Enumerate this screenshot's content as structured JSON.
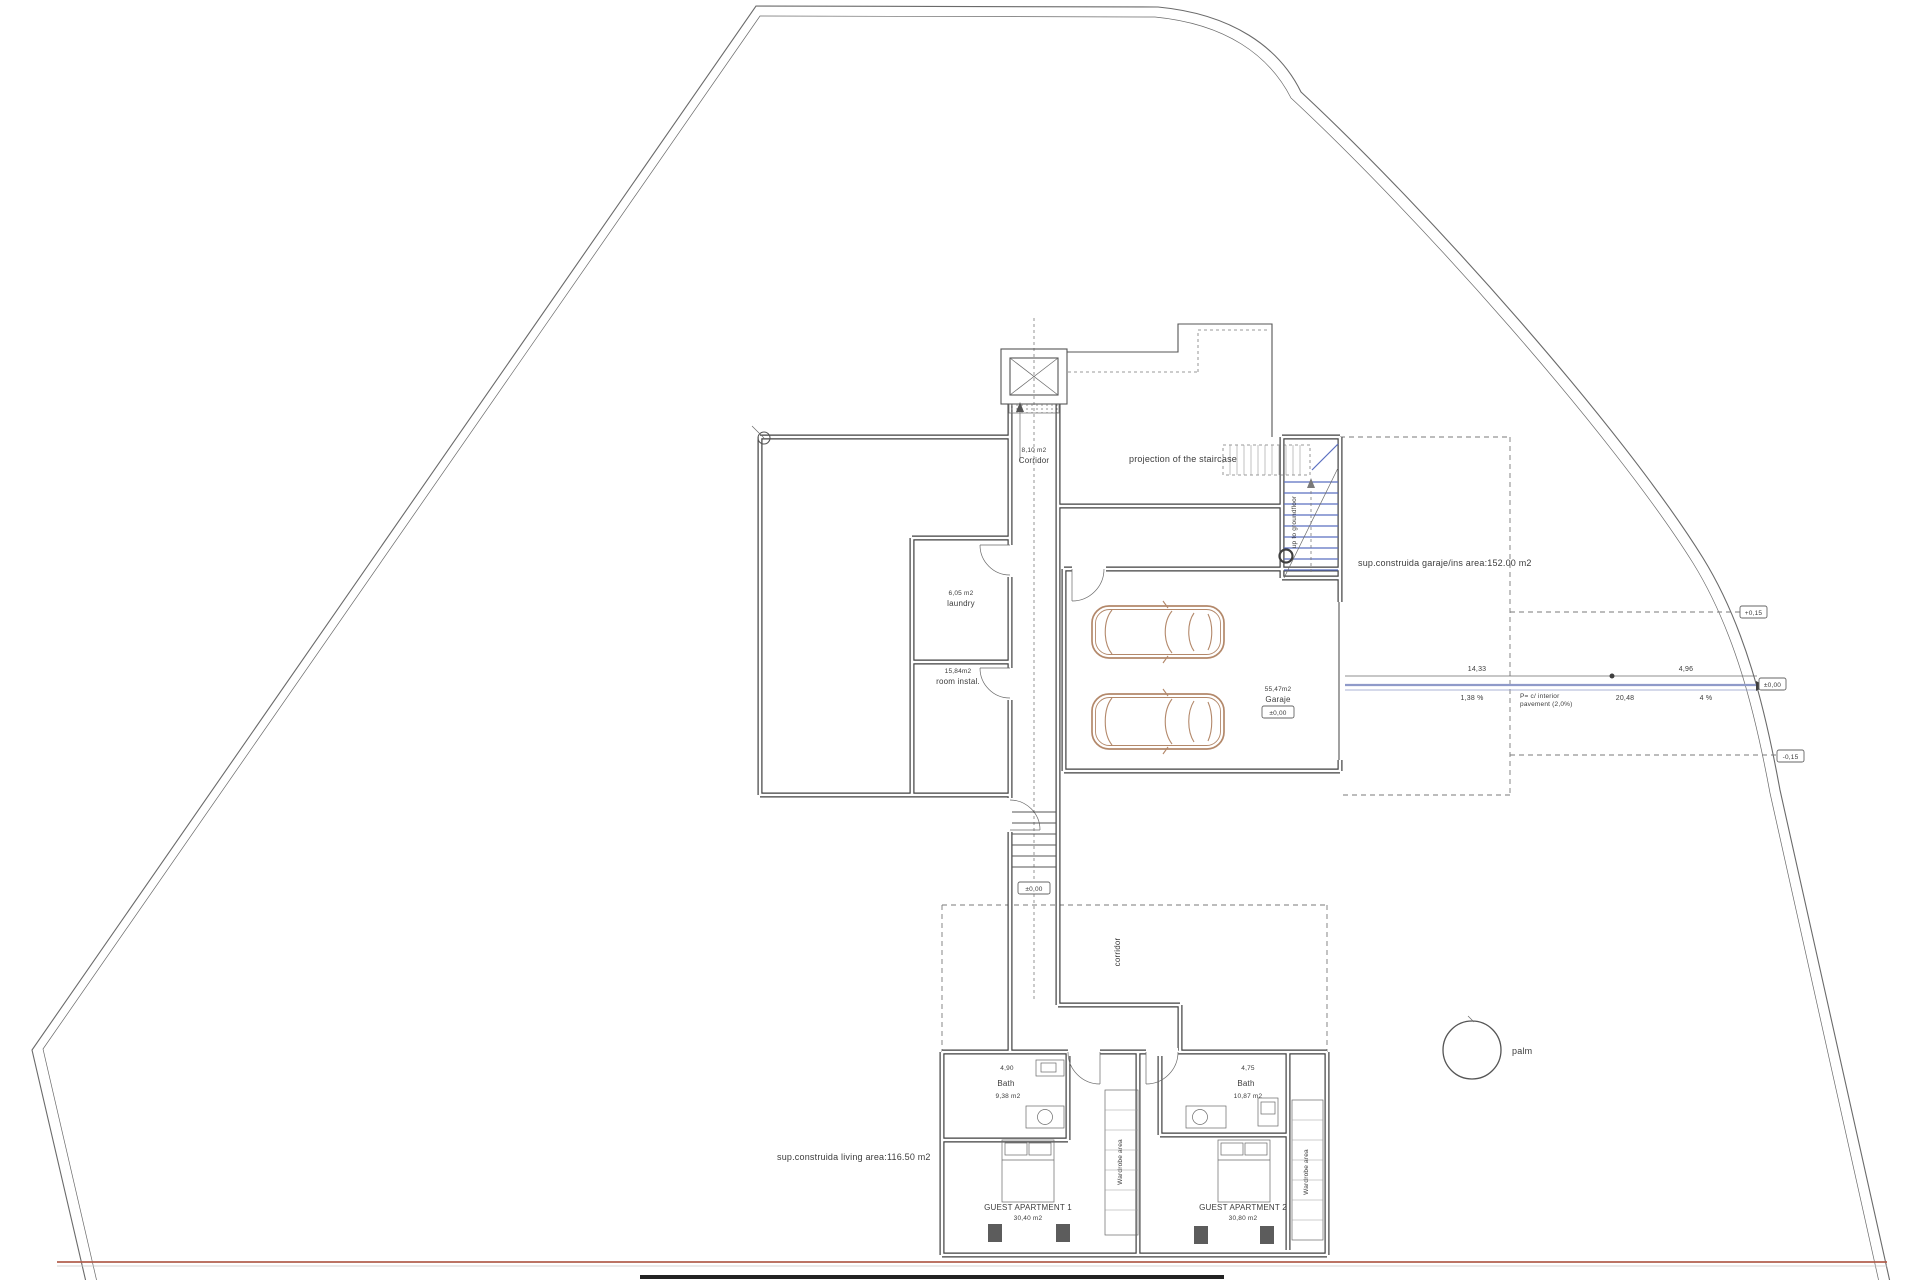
{
  "plan": {
    "colors": {
      "wall": "#3f3f3f",
      "line": "#555555",
      "stair": "#5b6fc0",
      "drive": "#8f9ac9",
      "car": "#b3886a",
      "street": "#b2604f",
      "text": "#3c3c3c"
    },
    "labels": {
      "projection_staircase": "projection of the staircase",
      "corridor_top_area": "8,10 m2",
      "corridor_top": "Corridor",
      "laundry_area": "6,05 m2",
      "laundry": "laundry",
      "instal_area": "15,84m2",
      "instal": "room instal.",
      "garage_area": "55,47m2",
      "garage": "Garaje",
      "garage_level": "±0,00",
      "garage_note": "sup.construida garaje/ins area:152.00 m2",
      "living_note": "sup.construida living area:116.50 m2",
      "up_stairs": "up to groundfloor",
      "stairs_level": "±0,00",
      "corridor_lower": "corridor",
      "bath1": "Bath",
      "bath1_area": "9,38 m2",
      "bath1_dim": "4,90",
      "bath2": "Bath",
      "bath2_area": "10,87 m2",
      "bath2_dim": "4,75",
      "apt1": "GUEST APARTMENT 1",
      "apt1_area": "30,40 m2",
      "apt2": "GUEST APARTMENT 2",
      "apt2_area": "30,80 m2",
      "wardrobe1": "Wardrobe area",
      "wardrobe2": "Wardrobe area",
      "palm": "palm",
      "drive_dim1": "14,33",
      "drive_dim2": "4,96",
      "drive_slope1": "1,38 %",
      "drive_note1": "P= c/ interior",
      "drive_note2": "pavement (2,0%)",
      "drive_len": "20,48",
      "drive_slope2": "4 %",
      "marker_top": "+0,15",
      "marker_mid": "±0,00",
      "marker_low": "-0,15"
    }
  }
}
